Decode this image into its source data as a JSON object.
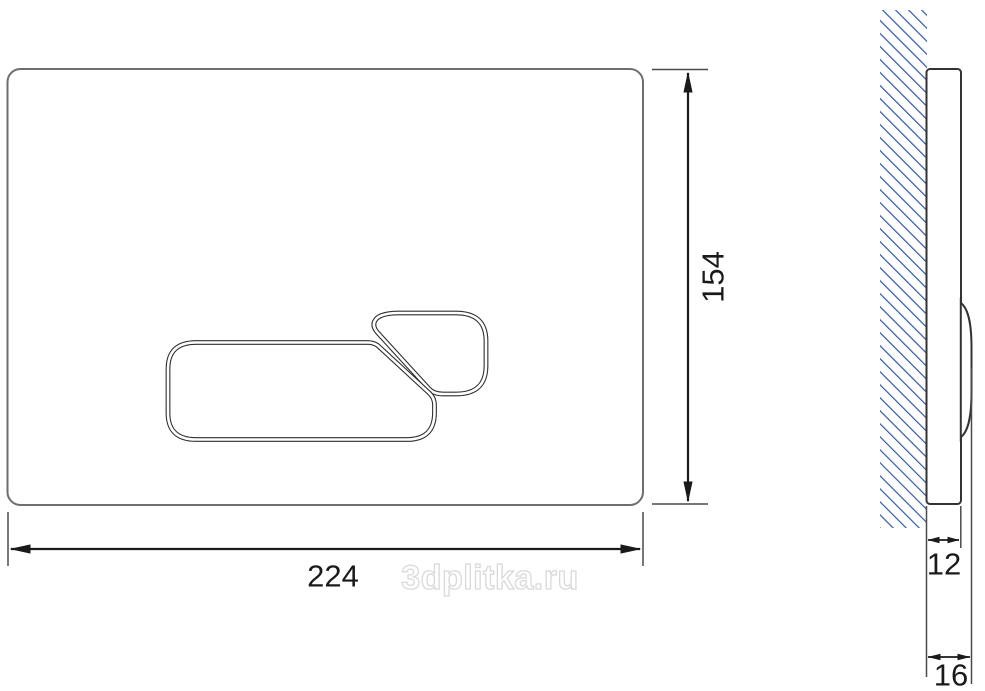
{
  "drawing": {
    "type": "technical-dimension-drawing",
    "subject": "toilet flush plate with two buttons, front view and side profile on hatched wall",
    "dimensions": {
      "width": "224",
      "height": "154",
      "panel_thickness": "12",
      "total_thickness": "16"
    },
    "watermark": "3dplitka.ru",
    "colors": {
      "hatch_blue": "#2e58a8",
      "dimension_line": "#1a1a1a",
      "plate_outline": "#6e6e6e",
      "button_outline": "#2f2f2f",
      "watermark_gray": "#d9d9d9",
      "background": "#ffffff"
    }
  }
}
